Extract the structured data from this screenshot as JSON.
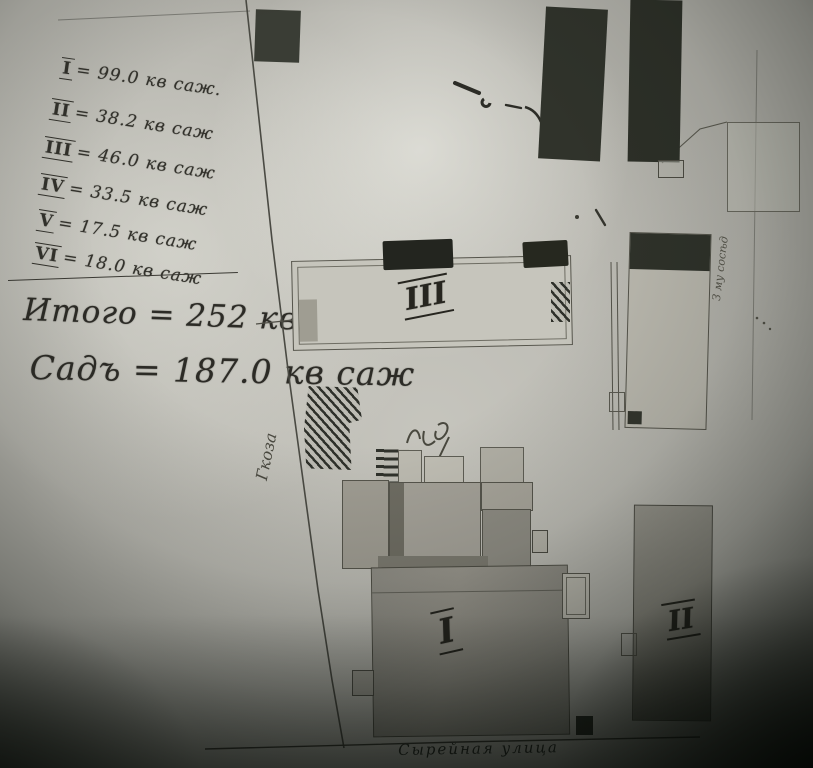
{
  "photo_colors": {
    "paper": "#b3b2ab",
    "ink": "#32312b",
    "pencil": "#55544b",
    "shadow": "#0a0d0a"
  },
  "notes": {
    "areas": [
      {
        "numeral": "I",
        "rest": "= 99.0 кв саж."
      },
      {
        "numeral": "II",
        "rest": "= 38.2 кв саж"
      },
      {
        "numeral": "III",
        "rest": "= 46.0 кв саж"
      },
      {
        "numeral": "IV",
        "rest": "= 33.5 кв саж"
      },
      {
        "numeral": "V",
        "rest": "= 17.5 кв саж"
      },
      {
        "numeral": "VI",
        "rest": "= 18.0 кв саж"
      }
    ],
    "total": "Итого = 252 кв саж",
    "garden": "Садъ = 187.0 кв саж"
  },
  "plan_labels": {
    "building_main": "I",
    "building_right": "II",
    "building_long": "III",
    "left_margin_vertical": "Гкоза",
    "right_margin_vertical": "З му сосѣд",
    "street": "Сырейная улица"
  }
}
